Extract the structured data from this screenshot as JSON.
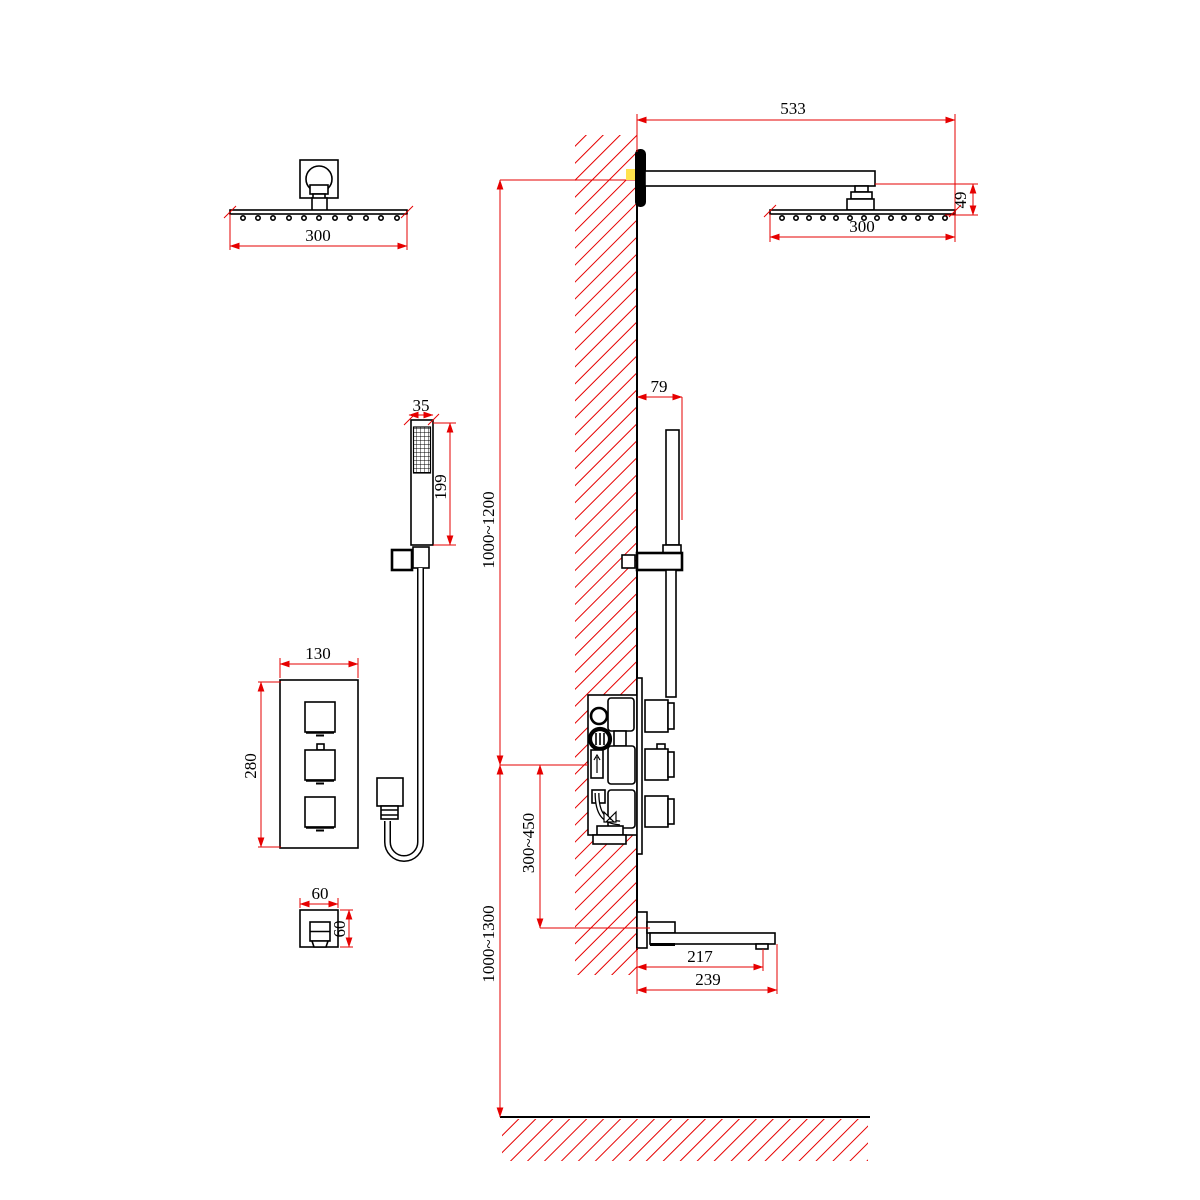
{
  "drawing": {
    "title": "shower-system-installation-diagram",
    "colors": {
      "dimension_red": "#e60000",
      "line_black": "#000000",
      "wall_highlight_yellow": "#ffe34d"
    },
    "dimensions": {
      "front_shower_head_width": "300",
      "shower_arm_length": "533",
      "head_to_arm_drop": "49",
      "side_shower_head_width": "300",
      "hand_shower_width": "35",
      "hand_shower_length": "199",
      "upper_height_range": "1000~1200",
      "hand_shower_wall_offset": "79",
      "control_panel_width": "130",
      "control_panel_height": "280",
      "wall_outlet_width": "60",
      "wall_outlet_height": "60",
      "valve_to_spout_height": "300~450",
      "lower_height_range": "1000~1300",
      "spout_outlet_reach": "217",
      "spout_total_reach": "239"
    }
  }
}
